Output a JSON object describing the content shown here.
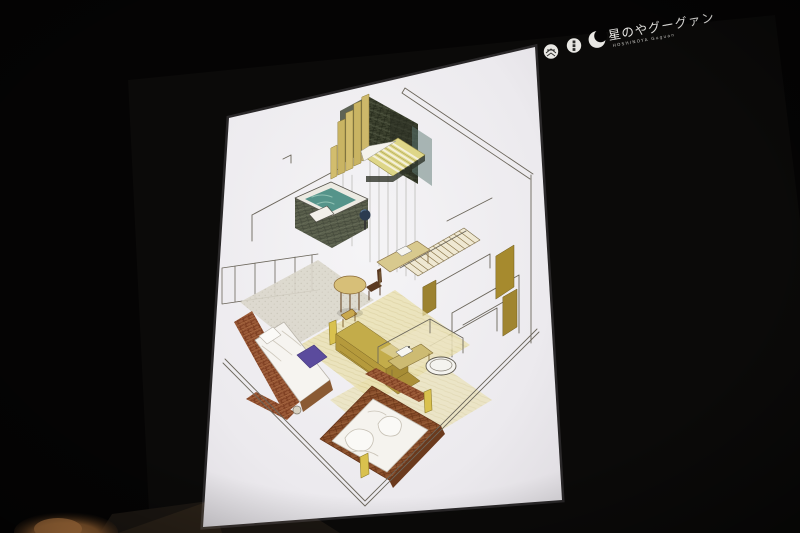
{
  "scene": {
    "description": "Photograph of a presentation slide projected on a screen in a dark hall",
    "room_darkness": "#050404",
    "warm_light_color": "#c18147",
    "screen_paper_color": "#f2f1f4"
  },
  "logo": {
    "title": "星のやグーグァン",
    "subtitle": "HOSHINOYA Guguan",
    "color": "#eae9e6",
    "icons": [
      {
        "name": "weave-circle-icon"
      },
      {
        "name": "seal-circle-icon"
      },
      {
        "name": "crescent-moon-icon"
      }
    ]
  },
  "sketch": {
    "kind": "hand-drawn isometric guest-room sketch",
    "elements": [
      "stepped timber slat wall",
      "dark stone feature wall",
      "sunken spa bathtub with teal water",
      "striped daybed",
      "glass partition lines",
      "staircase with hatched treads",
      "olive partition walls",
      "bed with white duvet and purple runner",
      "rust textured plaster band",
      "round table with wooden chairs",
      "writing desk with basin",
      "olive console cabinet",
      "platform bed with rumpled duvet",
      "vanity bench with sink",
      "oval soaking tub outline",
      "yellow bedside lamps"
    ],
    "palette": {
      "timber_olive": "#c9b463",
      "spa_teal": "#55948a",
      "dark_stone": "#3d422f",
      "rust_plaster": "#9a5a38",
      "wood_brown": "#8a4f2c",
      "floor_cream": "#e9dfab",
      "bedding_white": "#f6f4f0",
      "accent_purple": "#5b4b9d",
      "pen_line": "#5f5a50"
    }
  }
}
